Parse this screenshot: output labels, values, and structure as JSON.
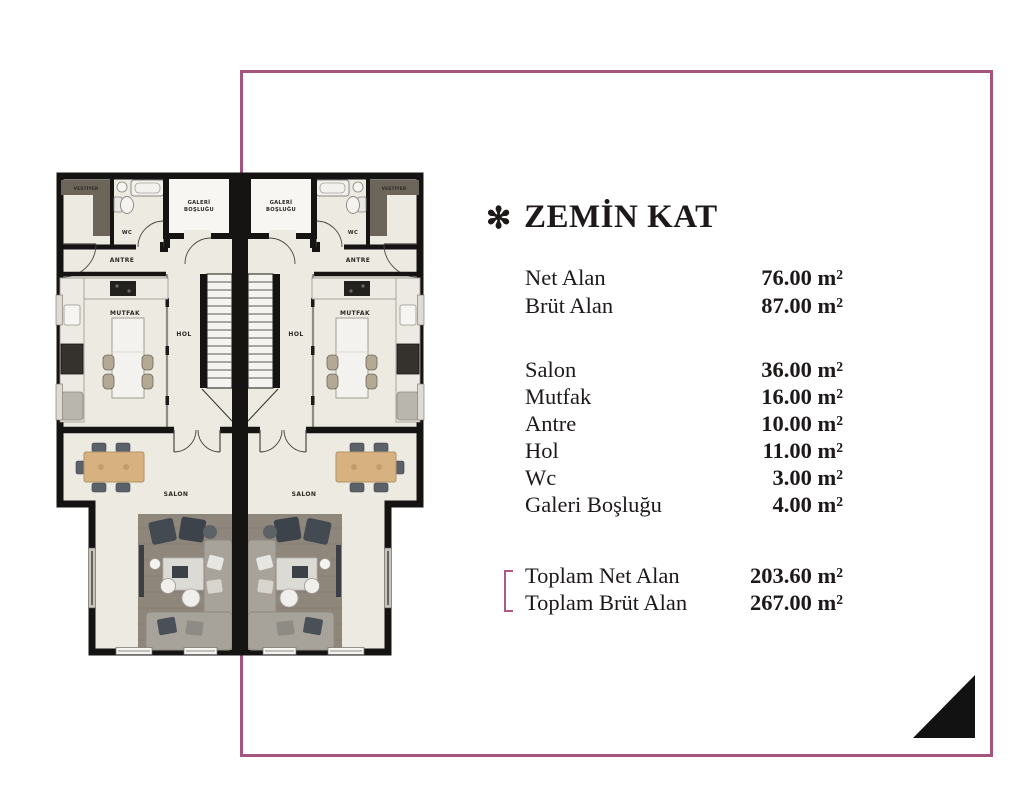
{
  "panel": {
    "marker": "✻",
    "title": "ZEMİN KAT",
    "summary": [
      {
        "label": "Net Alan",
        "value": "76.00 m²"
      },
      {
        "label": "Brüt Alan",
        "value": "87.00 m²"
      }
    ],
    "rooms": [
      {
        "label": "Salon",
        "value": "36.00 m²"
      },
      {
        "label": "Mutfak",
        "value": "16.00 m²"
      },
      {
        "label": "Antre",
        "value": "10.00 m²"
      },
      {
        "label": "Hol",
        "value": "11.00 m²"
      },
      {
        "label": "Wc",
        "value": "3.00 m²"
      },
      {
        "label": "Galeri Boşluğu",
        "value": "4.00 m²"
      }
    ],
    "totals": [
      {
        "label": "Toplam Net Alan",
        "value": "203.60 m²"
      },
      {
        "label": "Toplam Brüt Alan",
        "value": "267.00 m²"
      }
    ]
  },
  "floorplan": {
    "labels": {
      "vestiyer": "VESTİYER",
      "wc": "WC",
      "galeri_line1": "GALERİ",
      "galeri_line2": "BOŞLUĞU",
      "antre": "ANTRE",
      "mutfak": "MUTFAK",
      "hol": "HOL",
      "salon": "SALON"
    }
  },
  "colors": {
    "frame_pink": "#a5537f",
    "bracket_pink": "#b0568b",
    "text_dark": "#1d1919",
    "triangle_black": "#121212",
    "floor_cream": "#edeae1",
    "wall_black": "#151412"
  }
}
